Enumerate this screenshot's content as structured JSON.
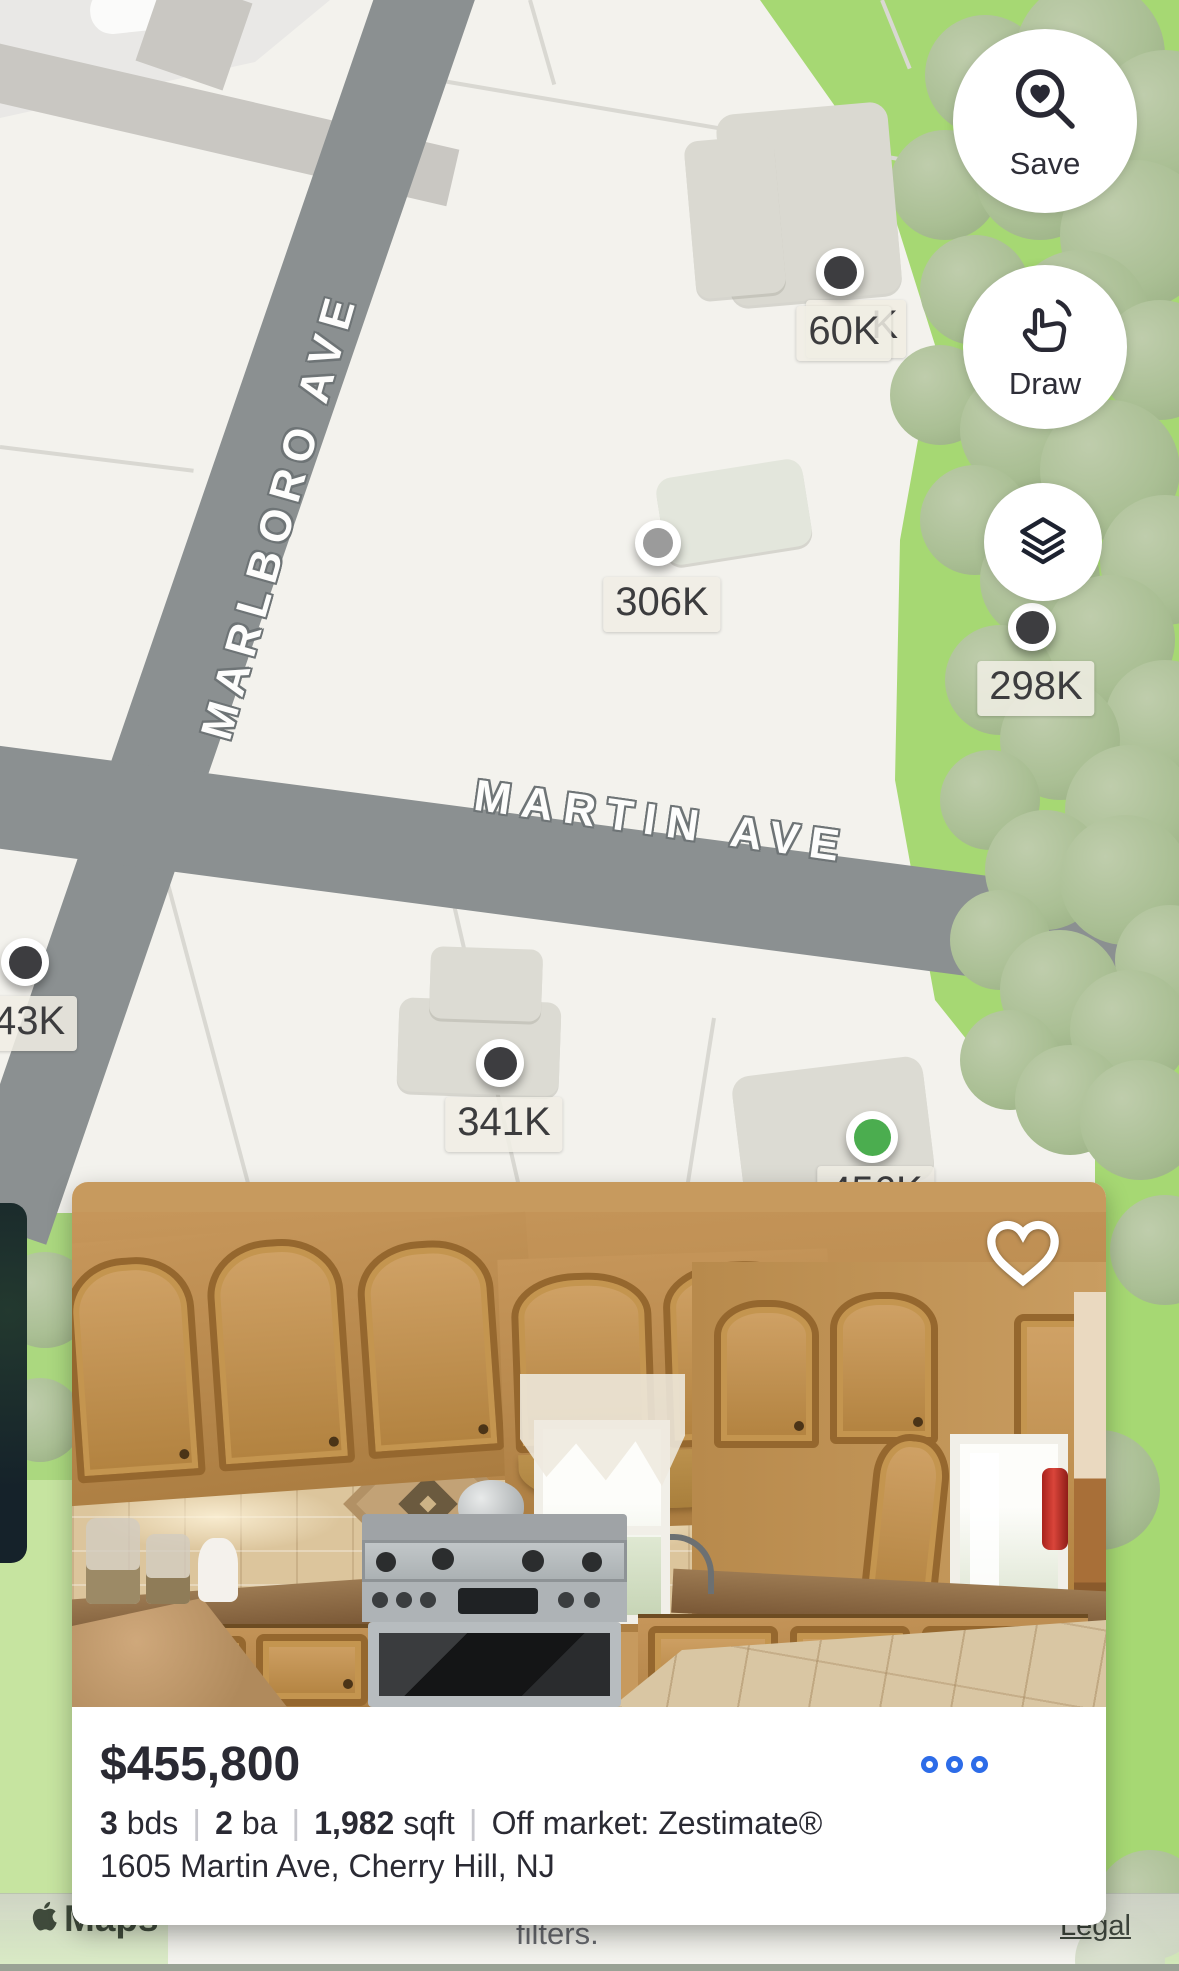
{
  "map": {
    "streets": {
      "marlboro": "MARLBORO AVE",
      "martin": "MARTIN AVE"
    },
    "markers": [
      {
        "id": "60k",
        "price": "60K",
        "variant": "dark"
      },
      {
        "id": "60k-hidden",
        "price": "K",
        "variant": "ghost"
      },
      {
        "id": "306k",
        "price": "306K",
        "variant": "gray"
      },
      {
        "id": "298k",
        "price": "298K",
        "variant": "dark"
      },
      {
        "id": "43k",
        "price": "43K",
        "variant": "dark"
      },
      {
        "id": "341k",
        "price": "341K",
        "variant": "dark"
      },
      {
        "id": "456k",
        "price": "456K",
        "variant": "green"
      }
    ],
    "controls": {
      "save_label": "Save",
      "draw_label": "Draw"
    }
  },
  "card": {
    "price": "$455,800",
    "facts": [
      {
        "value": "3",
        "unit": "bds"
      },
      {
        "value": "2",
        "unit": "ba"
      },
      {
        "value": "1,982",
        "unit": "sqft"
      }
    ],
    "status": "Off market: Zestimate®",
    "address": "1605 Martin Ave, Cherry Hill, NJ"
  },
  "attribution": {
    "brand": "Maps",
    "filters_text": "filters.",
    "legal": "Legal"
  },
  "colors": {
    "marker_dark": "#3d3d40",
    "marker_gray": "#9b9b9b",
    "marker_green": "#4bad4f",
    "menu_blue": "#2d6ce8",
    "road_gray": "#8b9091",
    "map_green": "#a6d873",
    "text_dark": "#2a2a33"
  }
}
